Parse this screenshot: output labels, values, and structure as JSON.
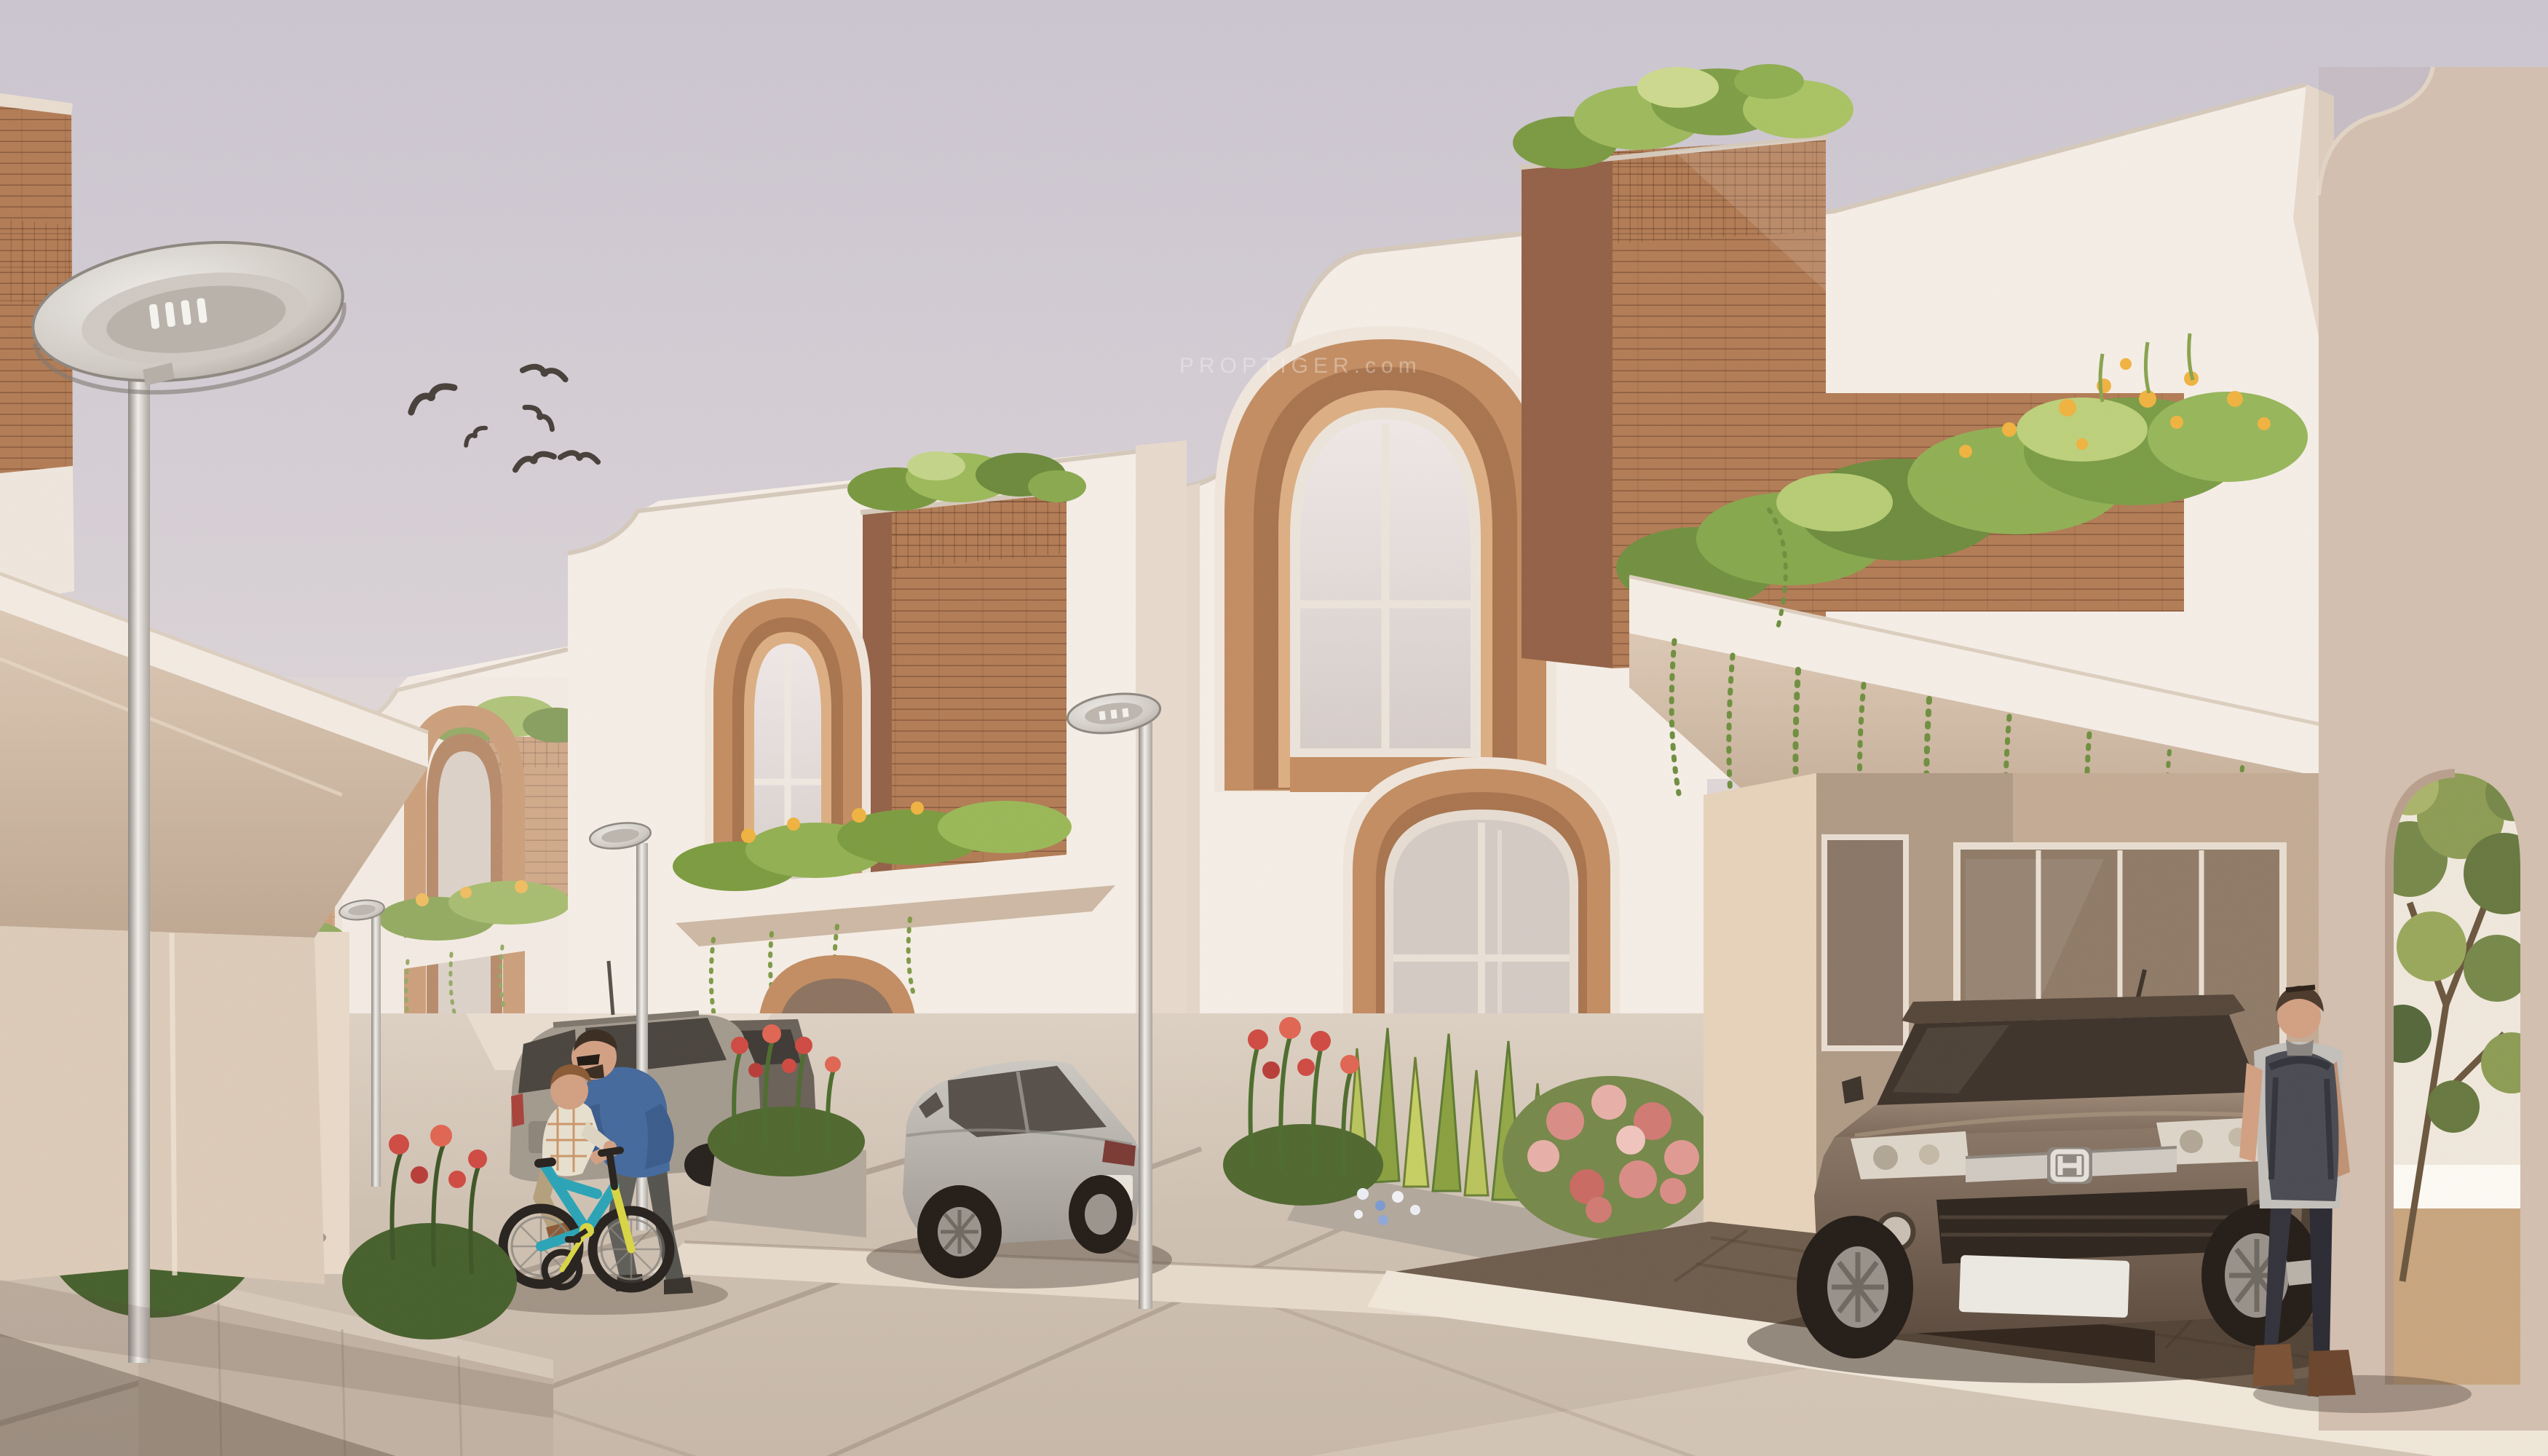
{
  "scene": {
    "type": "architectural-exterior-rendering",
    "description": "Sunlit modern residential street: receding row of white two-storey villas with copper arched windows, brick-clad roof towers topped with shrubs, balcony planters with yellow blooms and trailing vines, street lamps, parked cars, a father steadying a boy on a teal bicycle, and a man with a backpack beside a brown SUV in a carport",
    "watermark": "PROPTIGER.com",
    "sky": "pale lavender hazy daylight sky",
    "counts": {
      "birds": 6,
      "street_lamps": 4,
      "cars": 4,
      "people": 3,
      "bicycles": 1,
      "visible_house_modules": 6
    }
  },
  "objects": {
    "bird_flock": "flock of six birds flying",
    "lamp_a": "foreground oval LED street lamp on silver pole",
    "lamp_b": "street lamp in front of third villa",
    "lamp_c": "street lamp in far left row",
    "lamp_d": "street lamp in front of centre villa",
    "house_row": "receding row of white villas with copper arches and brick roof towers",
    "house_centre": "centre villa with two-storey copper arched window",
    "house_right": "foreground villa with carport, balcony planter and hanging vines",
    "suv": "brown Honda CR-V parked in carport, blank white plate",
    "crossover": "silver crossover coupe parked at kerb",
    "wagon": "grey estate car in side driveway",
    "hatchback": "yellow hatchback in side lane, blank white plate",
    "father": "man in blue denim jacket and sunglasses steadying the bicycle",
    "boy": "boy in plaid shirt and khaki trousers riding the bicycle",
    "pedestrian": "man in grey t-shirt, dark jeans, brown boots and dark backpack standing by the SUV",
    "bicycle": "teal and yellow kids bicycle with training wheel",
    "tree_arch": "tree seen through arched doorway in right wall",
    "planting": "rooftop shrubs, balcony planters with yellow blooms, trailing vines, red canna beds, variegated snake plants, pink flowering shrub"
  },
  "colors": {
    "sky_top": "#cbc5d0",
    "sky_low": "#efe5de",
    "wall_sun": "#f5eee6",
    "wall_light": "#efe6dd",
    "wall_shade": "#d9c6b4",
    "wall_deep": "#c5ab93",
    "copper": "#c38d62",
    "copper_deep": "#a8744e",
    "copper_light": "#dcae83",
    "brick": "#b27c55",
    "brick_dark": "#936147",
    "brick_light": "#c89a74",
    "coping": "#d5c9ba",
    "leaf": "#7c9c40",
    "leaf_light": "#b5cc5e",
    "leaf_dark": "#51702e",
    "flower_yellow": "#f0b340",
    "flower_red": "#cf4a42",
    "flower_pink": "#dd8f88",
    "road": "#c9bbac",
    "road_light": "#dbcfc2",
    "road_dark": "#a8978a",
    "curb": "#f0e7d9",
    "floor_dark": "#6e5c4c",
    "metal": "#d7d3cd",
    "metal_dark": "#8e8880",
    "glass": "#e9e1e0",
    "glass_dark": "#8a7767",
    "suv_body": "#6f5d4e",
    "suv_dark": "#473a30",
    "car_silver": "#bcb8b1",
    "car_yellow": "#d6cf4a",
    "car_grey": "#a39a8e",
    "bike_teal": "#2aa4b6",
    "bike_yellow": "#d9d544",
    "denim": "#44699c",
    "skin": "#d2a082",
    "jeans": "#33323b",
    "boot": "#7b5134",
    "tee": "#c3bfba",
    "pack": "#4a4b52",
    "hair": "#4c3a2c",
    "bird": "#47403a",
    "shadow": "#55463c"
  }
}
